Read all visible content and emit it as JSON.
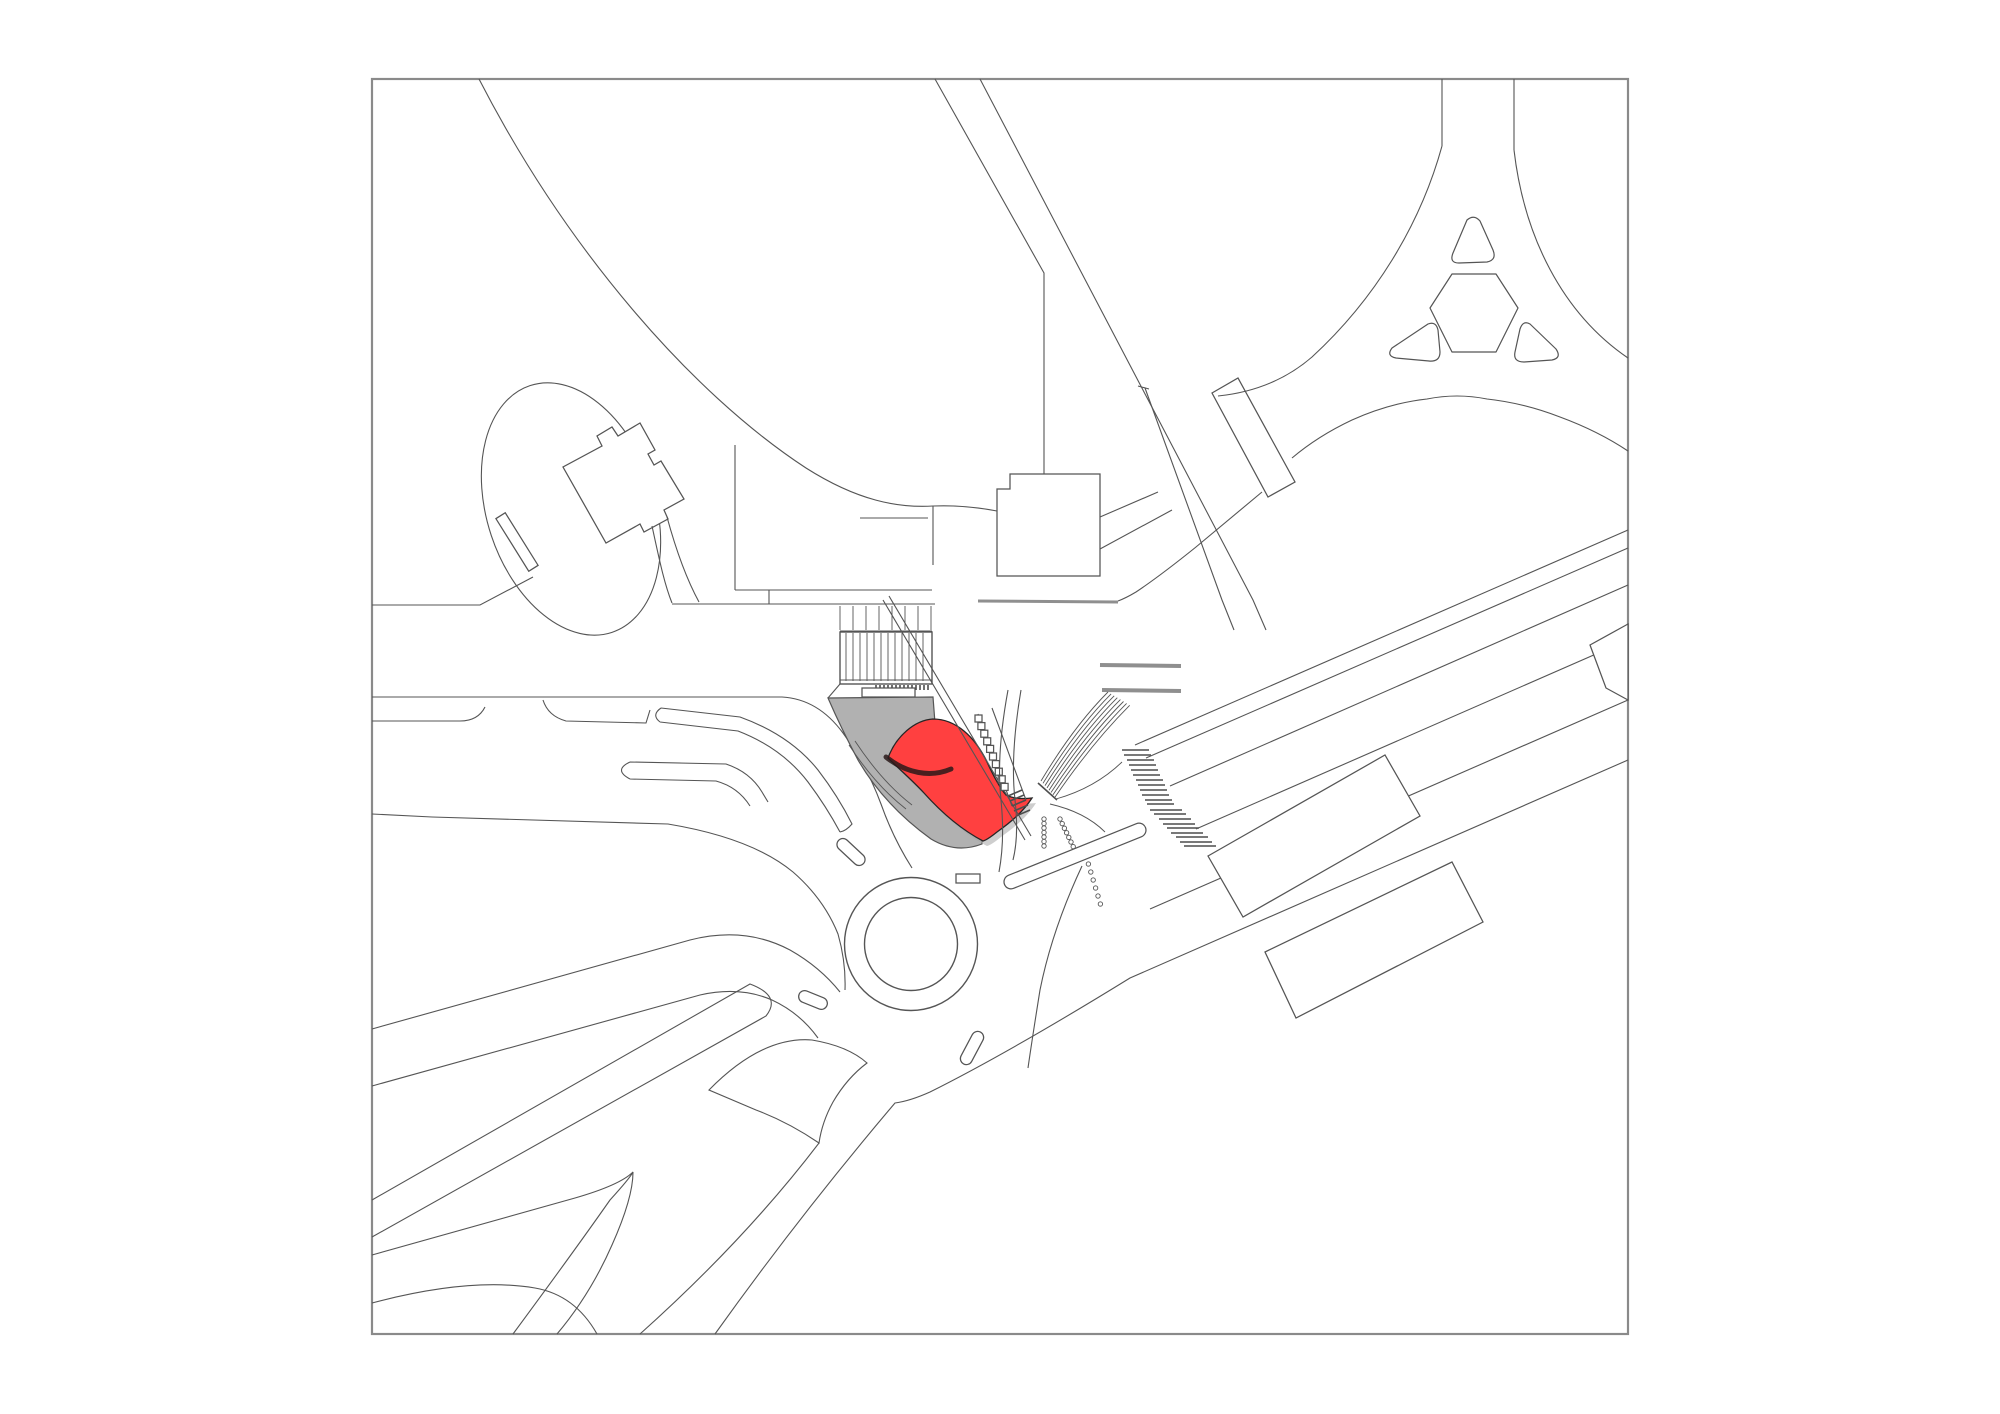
{
  "meta": {
    "document_type": "architectural site plan drawing",
    "canvas": {
      "width": 2000,
      "height": 1414
    },
    "border": {
      "x": 372,
      "y": 79,
      "width": 1256,
      "height": 1255
    }
  },
  "colors": {
    "background": "#ffffff",
    "line": "#555555",
    "border_gray": "#8a8a8a",
    "plaza_fill": "#b1b1b1",
    "building_highlight": "#ff4040",
    "highlight_outline": "#2a1a1a",
    "shadow_gray": "#a6a6a6",
    "wall_gray": "#8f8f8f",
    "hatch_dark": "#4d4d4d"
  },
  "features": [
    {
      "name": "plan-border",
      "description": "square drawing frame"
    },
    {
      "name": "park-sweep-curve",
      "description": "large curve from top edge to site center"
    },
    {
      "name": "garden-ellipse",
      "description": "tilted ellipse with entrance bar, north-west"
    },
    {
      "name": "rotated-square-building",
      "description": "existing building with notches beside ellipse"
    },
    {
      "name": "terrace-and-stairs",
      "description": "two stair flights with tread lines, center"
    },
    {
      "name": "plaza",
      "description": "gray shaded forecourt polygon"
    },
    {
      "name": "highlight-pavilion",
      "description": "red S-shaped proposed building on plaza"
    },
    {
      "name": "ramp",
      "description": "thin double diagonal line across plaza"
    },
    {
      "name": "escalator-band",
      "description": "tilted band with small square landings"
    },
    {
      "name": "arc-fan",
      "description": "fan of eight concentric curved steps"
    },
    {
      "name": "platform-walls",
      "description": "three thick gray wall/bench bars"
    },
    {
      "name": "north-street",
      "description": "road entering from top edge, bending vertical"
    },
    {
      "name": "north-buildings",
      "description": "square building and angled bar building"
    },
    {
      "name": "trident-roundabout",
      "description": "Y-junction with hexagon and three rounded triangle islands, north-east"
    },
    {
      "name": "se-road-bundle",
      "description": "parallel diagonal carriageway lines to south-east"
    },
    {
      "name": "se-buildings",
      "description": "two rotated rectangular buildings along road"
    },
    {
      "name": "zebra-crossings",
      "description": "two ladder-stripe pedestrian crossings"
    },
    {
      "name": "bollard-dot-rows",
      "description": "chains of small circles across roads"
    },
    {
      "name": "small-roundabout",
      "description": "double circle roundabout with pill medians"
    },
    {
      "name": "sw-road",
      "description": "diagonal avenue with rounded median pill, south-west"
    },
    {
      "name": "grass-slivers",
      "description": "pointed leaf and fin shaped islands, south"
    }
  ],
  "counts": {
    "upper_stair_treads": 8,
    "lower_stair_treads": 12,
    "fan_arcs": 8,
    "trident_islands": 3,
    "zebra_crossings": 2,
    "se_parallel_road_lines": 6
  }
}
